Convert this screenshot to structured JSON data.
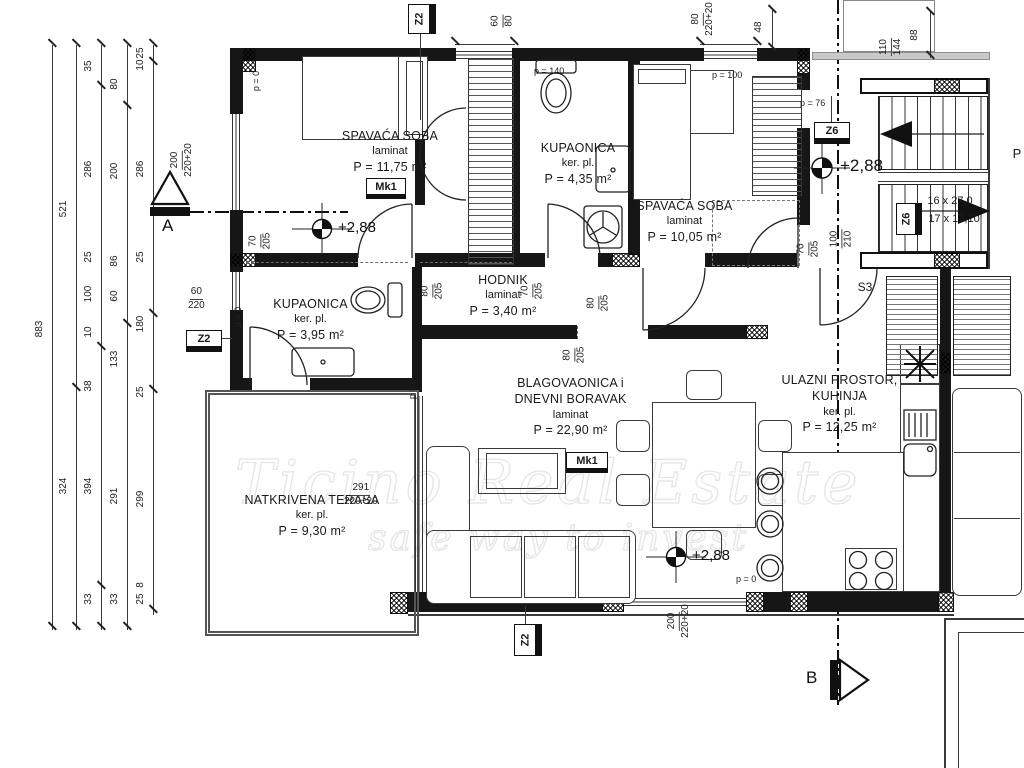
{
  "rooms": {
    "bedroom1": {
      "name": "SPAVAĆA SOBA",
      "floor": "laminat",
      "area": "P = 11,75 m²"
    },
    "bath1": {
      "name": "KUPAONICA",
      "floor": "ker. pl.",
      "area": "P = 4,35 m²"
    },
    "bedroom2": {
      "name": "SPAVAĆA SOBA",
      "floor": "laminat",
      "area": "P = 10,05 m²"
    },
    "hall": {
      "name": "HODNIK",
      "floor": "laminat",
      "area": "P = 3,40 m²"
    },
    "bath2": {
      "name": "KUPAONICA",
      "floor": "ker. pl.",
      "area": "P = 3,95 m²"
    },
    "living": {
      "name1": "BLAGOVAONICA i",
      "name2": "DNEVNI BORAVAK",
      "floor": "laminat",
      "area": "P = 22,90 m²"
    },
    "terrace": {
      "name": "NATKRIVENA TERASA",
      "floor": "ker. pl.",
      "area": "P = 9,30 m²"
    },
    "kitchen": {
      "name1": "ULAZNI PROSTOR,",
      "name2": "KUHINJA",
      "floor": "ker. pl.",
      "area": "P = 12,25 m²"
    }
  },
  "markers": {
    "z2": "Z2",
    "z6": "Z6",
    "mk1": "Mk1",
    "s3": "S3",
    "a": "A",
    "b": "B",
    "level": "+2,88",
    "p_cut": "P",
    "stairs1": "16 x 27,0",
    "stairs2": "17 x 17,10",
    "p0": "p = 0",
    "p76": "p = 76",
    "p100": "p = 100",
    "p140": "p = 140"
  },
  "dims": {
    "win_top1": {
      "a": "60",
      "b": "80"
    },
    "win_top2": {
      "a": "80",
      "b": "220+20"
    },
    "d48": "48",
    "d88": "88",
    "win_shaft": {
      "a": "110",
      "b": "144"
    },
    "win_left": {
      "a": "200",
      "b": "220+20"
    },
    "door_bed1": {
      "a": "70",
      "b": "205"
    },
    "win_bath2": {
      "a": "60",
      "b": "220"
    },
    "door_hall": {
      "a": "80",
      "b": "205"
    },
    "door_bath1": {
      "a": "70",
      "b": "205"
    },
    "door_bed2": {
      "a": "80",
      "b": "205"
    },
    "opening_living": {
      "a": "80",
      "b": "205"
    },
    "door_bed2b": {
      "a": "70",
      "b": "205"
    },
    "door_entry": {
      "a": "100",
      "b": "210"
    },
    "win_terrace": {
      "a": "291",
      "b": "220+20"
    },
    "win_bottom": {
      "a": "200",
      "b": "220+20"
    }
  },
  "chains": {
    "c1": "883",
    "c2a": "521",
    "c2b": "324",
    "c3a": "35",
    "c3b": "286",
    "c3c": "25",
    "c3d": "100",
    "c3e": "10",
    "c3f": "38",
    "c3g": "394",
    "c3h": "33",
    "c4a": "80",
    "c4b": "200",
    "c4c": "86",
    "c4d": "60",
    "c4e": "133",
    "c4f": "291",
    "c4g": "33",
    "c5a": "25",
    "c5b": "10",
    "c5c": "286",
    "c5d": "25",
    "c5e": "180",
    "c5f": "25",
    "c5g": "299",
    "c5h": "8",
    "c5i": "25"
  },
  "watermark": {
    "line1": "Ticino Real Estate",
    "line2": "safe way to invest"
  }
}
